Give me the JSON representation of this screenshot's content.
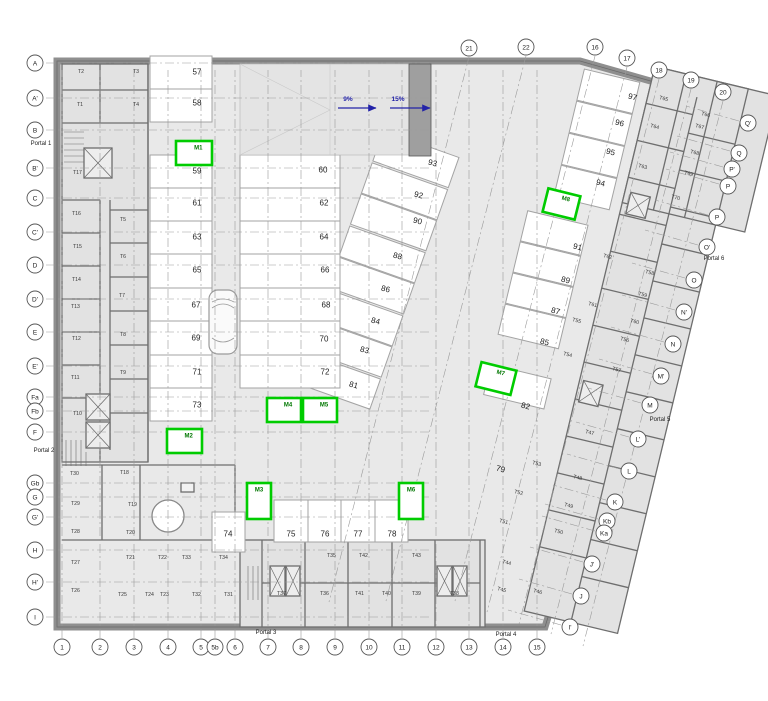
{
  "drawing": {
    "type": "basement-parking-floor-plan",
    "colors": {
      "wall": "#8f8f8f",
      "wall_line": "#6e6e6e",
      "floor": "#e9e9e9",
      "room": "#e2e2e2",
      "stall": "#ffffff",
      "stall_line": "#a3a3a3",
      "grid_line": "#9a9a9a",
      "axis_stroke": "#555555",
      "text": "#222222",
      "storage_text": "#3a3a3a",
      "green": "#00cc00",
      "green_text": "#007700",
      "ramp_block": "#9f9f9f",
      "arrow_blue": "#2323a8"
    }
  },
  "axes": {
    "left": [
      [
        "A",
        63
      ],
      [
        "A'",
        98
      ],
      [
        "B",
        130
      ],
      [
        "B'",
        168
      ],
      [
        "C",
        198
      ],
      [
        "C'",
        232
      ],
      [
        "D",
        265
      ],
      [
        "D'",
        299
      ],
      [
        "E",
        332
      ],
      [
        "E'",
        366
      ],
      [
        "Fa",
        397
      ],
      [
        "Fb",
        411
      ],
      [
        "F",
        432
      ],
      [
        "Gb",
        483
      ],
      [
        "G",
        497
      ],
      [
        "G'",
        517
      ],
      [
        "H",
        550
      ],
      [
        "H'",
        582
      ],
      [
        "I",
        617
      ]
    ],
    "bottom": [
      [
        "1",
        62
      ],
      [
        "2",
        100
      ],
      [
        "3",
        134
      ],
      [
        "4",
        168
      ],
      [
        "5",
        201
      ],
      [
        "5b",
        215
      ],
      [
        "6",
        235
      ],
      [
        "7",
        268
      ],
      [
        "8",
        301
      ],
      [
        "9",
        335
      ],
      [
        "10",
        369
      ],
      [
        "11",
        402
      ],
      [
        "12",
        436
      ],
      [
        "13",
        469
      ],
      [
        "14",
        503
      ],
      [
        "15",
        537
      ]
    ],
    "top": [
      [
        "21",
        469,
        48
      ],
      [
        "22",
        526,
        47
      ],
      [
        "16",
        595,
        47
      ],
      [
        "17",
        627,
        58
      ],
      [
        "18",
        659,
        70
      ],
      [
        "19",
        691,
        80
      ],
      [
        "20",
        723,
        92
      ]
    ],
    "right": [
      [
        "Q'",
        748,
        123
      ],
      [
        "Q",
        739,
        153
      ],
      [
        "P'",
        732,
        169
      ],
      [
        "P",
        728,
        186
      ],
      [
        "P",
        717,
        217
      ],
      [
        "O'",
        707,
        247
      ],
      [
        "O",
        694,
        280
      ],
      [
        "N'",
        684,
        312
      ],
      [
        "N",
        673,
        344
      ],
      [
        "M'",
        661,
        376
      ],
      [
        "M",
        650,
        405
      ],
      [
        "L'",
        638,
        439
      ],
      [
        "L",
        629,
        471
      ],
      [
        "K",
        615,
        502
      ],
      [
        "Kb",
        607,
        521
      ],
      [
        "Ka",
        604,
        533
      ],
      [
        "J'",
        592,
        564
      ],
      [
        "J",
        581,
        596
      ],
      [
        "I'",
        570,
        627
      ]
    ]
  },
  "parking_spaces": [
    [
      "57",
      197,
      72,
      0
    ],
    [
      "58",
      197,
      103,
      0
    ],
    [
      "59",
      197,
      171,
      0
    ],
    [
      "61",
      197,
      203,
      0
    ],
    [
      "63",
      197,
      237,
      0
    ],
    [
      "65",
      197,
      270,
      0
    ],
    [
      "67",
      196,
      305,
      0
    ],
    [
      "69",
      196,
      338,
      0
    ],
    [
      "71",
      197,
      372,
      0
    ],
    [
      "73",
      197,
      405,
      0
    ],
    [
      "60",
      323,
      170,
      0
    ],
    [
      "62",
      324,
      203,
      0
    ],
    [
      "64",
      324,
      237,
      0
    ],
    [
      "66",
      325,
      270,
      0
    ],
    [
      "68",
      326,
      305,
      0
    ],
    [
      "70",
      324,
      339,
      0
    ],
    [
      "72",
      325,
      372,
      0
    ],
    [
      "74",
      228,
      534,
      0
    ],
    [
      "75",
      291,
      534,
      0
    ],
    [
      "76",
      325,
      534,
      0
    ],
    [
      "77",
      358,
      534,
      0
    ],
    [
      "78",
      392,
      534,
      0
    ],
    [
      "79",
      500,
      469,
      14
    ],
    [
      "81",
      353,
      385,
      14
    ],
    [
      "82",
      525,
      406,
      14
    ],
    [
      "83",
      364,
      350,
      14
    ],
    [
      "84",
      375,
      321,
      14
    ],
    [
      "85",
      544,
      342,
      14
    ],
    [
      "86",
      385,
      289,
      14
    ],
    [
      "87",
      555,
      311,
      14
    ],
    [
      "88",
      397,
      256,
      14
    ],
    [
      "89",
      565,
      280,
      14
    ],
    [
      "90",
      417,
      221,
      14
    ],
    [
      "91",
      577,
      247,
      14
    ],
    [
      "92",
      418,
      195,
      14
    ],
    [
      "93",
      432,
      163,
      14
    ],
    [
      "94",
      600,
      183,
      14
    ],
    [
      "95",
      610,
      152,
      14
    ],
    [
      "96",
      619,
      123,
      14
    ],
    [
      "97",
      632,
      97,
      14
    ]
  ],
  "storage_rooms": [
    [
      "T1",
      77,
      104,
      0
    ],
    [
      "T2",
      78,
      71,
      0
    ],
    [
      "T3",
      133,
      71,
      0
    ],
    [
      "T4",
      133,
      104,
      0
    ],
    [
      "T5",
      120,
      219,
      0
    ],
    [
      "T6",
      120,
      256,
      0
    ],
    [
      "T7",
      119,
      295,
      0
    ],
    [
      "T8",
      120,
      334,
      0
    ],
    [
      "T9",
      120,
      372,
      0
    ],
    [
      "T10",
      73,
      413,
      0
    ],
    [
      "T11",
      71,
      377,
      0
    ],
    [
      "T12",
      72,
      338,
      0
    ],
    [
      "T13",
      71,
      306,
      0
    ],
    [
      "T14",
      72,
      279,
      0
    ],
    [
      "T15",
      73,
      246,
      0
    ],
    [
      "T16",
      72,
      213,
      0
    ],
    [
      "T17",
      73,
      172,
      0
    ],
    [
      "T18",
      120,
      472,
      0
    ],
    [
      "T19",
      128,
      504,
      0
    ],
    [
      "T20",
      126,
      532,
      0
    ],
    [
      "T21",
      126,
      557,
      0
    ],
    [
      "T22",
      158,
      557,
      0
    ],
    [
      "T23",
      160,
      594,
      0
    ],
    [
      "T24",
      145,
      594,
      0
    ],
    [
      "T25",
      118,
      594,
      0
    ],
    [
      "T26",
      71,
      590,
      0
    ],
    [
      "T27",
      71,
      562,
      0
    ],
    [
      "T28",
      71,
      531,
      0
    ],
    [
      "T29",
      71,
      503,
      0
    ],
    [
      "T30",
      70,
      473,
      0
    ],
    [
      "T31",
      224,
      594,
      0
    ],
    [
      "T32",
      192,
      594,
      0
    ],
    [
      "T33",
      182,
      557,
      0
    ],
    [
      "T34",
      219,
      557,
      0
    ],
    [
      "T35",
      327,
      555,
      0
    ],
    [
      "T36",
      320,
      593,
      0
    ],
    [
      "T37",
      277,
      593,
      0
    ],
    [
      "T38",
      450,
      593,
      0
    ],
    [
      "T39",
      412,
      593,
      0
    ],
    [
      "T40",
      382,
      593,
      0
    ],
    [
      "T41",
      355,
      593,
      0
    ],
    [
      "T42",
      359,
      555,
      0
    ],
    [
      "T43",
      412,
      555,
      0
    ],
    [
      "T44",
      502,
      561,
      14
    ],
    [
      "T45",
      497,
      588,
      14
    ],
    [
      "T46",
      533,
      590,
      14
    ],
    [
      "T47",
      585,
      431,
      14
    ],
    [
      "T48",
      573,
      476,
      14
    ],
    [
      "T49",
      564,
      504,
      14
    ],
    [
      "T50",
      554,
      530,
      14
    ],
    [
      "T51",
      499,
      520,
      14
    ],
    [
      "T52",
      514,
      491,
      14
    ],
    [
      "T53",
      532,
      462,
      14
    ],
    [
      "T54",
      563,
      353,
      14
    ],
    [
      "T55",
      572,
      319,
      14
    ],
    [
      "T56",
      620,
      338,
      14
    ],
    [
      "T57",
      612,
      368,
      14
    ],
    [
      "T58",
      645,
      271,
      14
    ],
    [
      "T59",
      638,
      293,
      14
    ],
    [
      "T60",
      630,
      320,
      14
    ],
    [
      "T61",
      588,
      303,
      14
    ],
    [
      "T62",
      603,
      255,
      14
    ],
    [
      "T63",
      638,
      165,
      14
    ],
    [
      "T64",
      650,
      125,
      14
    ],
    [
      "T65",
      659,
      97,
      14
    ],
    [
      "T66",
      701,
      113,
      14
    ],
    [
      "T67",
      695,
      125,
      14
    ],
    [
      "T68",
      690,
      151,
      14
    ],
    [
      "T69",
      684,
      172,
      14
    ],
    [
      "T70",
      671,
      196,
      14
    ]
  ],
  "moto_spaces": [
    [
      "M1",
      176,
      141,
      36,
      24,
      0
    ],
    [
      "M2",
      167,
      429,
      35,
      24,
      0
    ],
    [
      "M3",
      247,
      483,
      24,
      36,
      0
    ],
    [
      "M4",
      267,
      398,
      34,
      24,
      0
    ],
    [
      "M5",
      303,
      398,
      34,
      24,
      0
    ],
    [
      "M6",
      399,
      483,
      24,
      36,
      0
    ],
    [
      "M7",
      478,
      366,
      36,
      25,
      14
    ],
    [
      "M8",
      545,
      192,
      33,
      24,
      14
    ]
  ],
  "portals": [
    [
      "Portal 1",
      27,
      145
    ],
    [
      "Portal 2",
      30,
      452
    ],
    [
      "Portal 3",
      252,
      634
    ],
    [
      "Portal 4",
      492,
      636
    ],
    [
      "Portal 5",
      646,
      421
    ],
    [
      "Portal 6",
      700,
      260
    ]
  ],
  "ramp": {
    "labels": [
      {
        "text": "9%",
        "x": 348,
        "y": 101,
        "ax": 338,
        "ay": 108,
        "len": 38
      },
      {
        "text": "15%",
        "x": 398,
        "y": 101,
        "ax": 390,
        "ay": 108,
        "len": 40
      }
    ]
  }
}
